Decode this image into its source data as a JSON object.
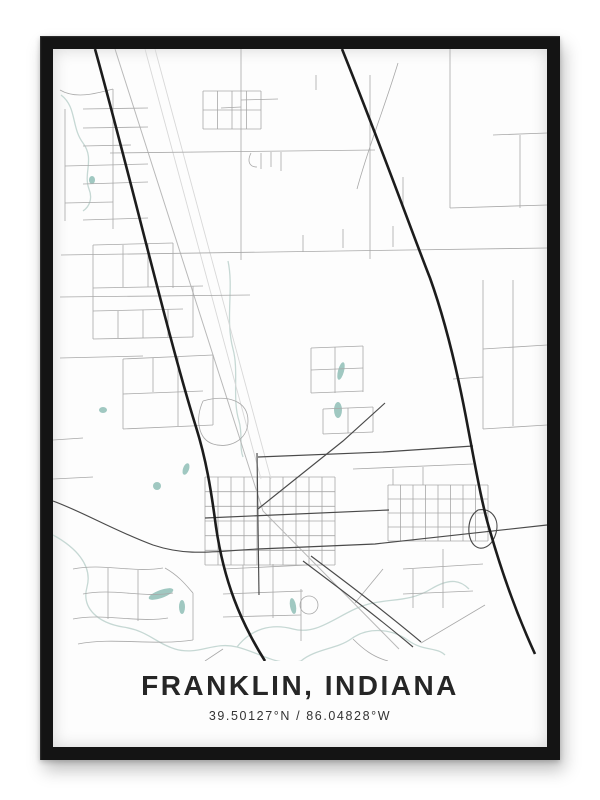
{
  "poster": {
    "title": "FRANKLIN, INDIANA",
    "coordinates": "39.50127°N / 86.04828°W"
  },
  "colors": {
    "frame": "#141414",
    "poster_bg": "#fdfdfd",
    "road_major": "#1c1c1c",
    "road_medium": "#4a4a4a",
    "road_minor": "#a8a8a8",
    "road_faint": "#d8d8d8",
    "rail": "#b9b9b9",
    "water": "#a0c8c1",
    "creek": "#c6d8d4",
    "title_text": "#262626",
    "coords_text": "#333333"
  },
  "map": {
    "viewbox": "0 0 494 612",
    "creeks": [
      "M0,486 C22,498 40,516 34,538 C28,560 46,574 70,578 C96,582 102,594 122,600 C146,607 160,592 184,598 C208,604 224,618 248,612",
      "M184,598 C198,580 218,574 240,580 C262,586 280,570 302,560 C330,547 352,556 378,540 C398,528 408,532 416,540",
      "M8,46 C24,58 18,78 30,94 C42,110 30,124 36,140 C40,150 36,158 30,162",
      "M248,612 C262,600 284,600 298,590 C316,577 340,580 356,592 C370,602 384,598 392,606",
      "M175,212 C181,240 172,270 180,300 C186,322 179,350 186,372 C190,386 186,398 190,408"
    ],
    "water_ellipses": [
      {
        "cx": 108,
        "cy": 545,
        "rx": 13,
        "ry": 4,
        "rot": -20
      },
      {
        "cx": 129,
        "cy": 558,
        "rx": 3,
        "ry": 7,
        "rot": 0
      },
      {
        "cx": 240,
        "cy": 557,
        "rx": 3,
        "ry": 8,
        "rot": -10
      },
      {
        "cx": 288,
        "cy": 322,
        "rx": 3,
        "ry": 9,
        "rot": 15
      },
      {
        "cx": 285,
        "cy": 361,
        "rx": 4,
        "ry": 8,
        "rot": 0
      },
      {
        "cx": 104,
        "cy": 437,
        "rx": 4,
        "ry": 4,
        "rot": 0
      },
      {
        "cx": 133,
        "cy": 420,
        "rx": 3,
        "ry": 6,
        "rot": 20
      },
      {
        "cx": 50,
        "cy": 361,
        "rx": 4,
        "ry": 3,
        "rot": 0
      },
      {
        "cx": 39,
        "cy": 131,
        "rx": 3,
        "ry": 4,
        "rot": 0
      }
    ],
    "layers": [
      {
        "cls": "faint",
        "paths": [
          "M102,0 L218,430",
          "M92,0 L208,430"
        ]
      },
      {
        "cls": "rail",
        "paths": [
          "M62,0 L210,462 L346,600"
        ]
      },
      {
        "cls": "road-min",
        "paths": [
          "M188,0 L188,211",
          "M188,51 L225,50",
          "M168,59 L188,58",
          "M263,26 L263,41",
          "M57,104 L322,101",
          "M208,104 L208,120",
          "M218,103 L218,118",
          "M228,103 L228,122",
          "M198,104 C194,112 196,118 204,118",
          "M8,206 L494,199",
          "M397,0 L397,159",
          "M317,26 L317,210",
          "M345,14 C331,60 316,96 304,140",
          "M440,86 L494,84",
          "M467,86 L467,159",
          "M397,159 L494,156",
          "M350,128 L350,159",
          "M290,199 L290,180",
          "M340,198 L340,177",
          "M250,203 L250,186",
          "M12,60 L12,172",
          "M60,40 L60,180",
          "M7,41 C22,50 42,45 60,40",
          "M30,60 L95,59",
          "M30,79 L95,78",
          "M30,97 L78,96",
          "M12,117 L95,115",
          "M30,135 L95,133",
          "M12,154 L60,153",
          "M30,171 L95,169",
          "M40,196 L40,290",
          "M40,196 L120,194",
          "M120,194 L120,239",
          "M40,239 L150,237",
          "M70,196 L70,238",
          "M95,195 L95,238",
          "M40,262 L130,260",
          "M40,290 L140,288",
          "M65,262 L65,289",
          "M90,261 L90,289",
          "M115,260 L115,288",
          "M140,237 L140,288",
          "M7,248 L197,246",
          "M7,309 L90,307",
          "M70,310 L160,306",
          "M70,310 L70,380",
          "M70,345 L150,342",
          "M70,380 L160,376",
          "M100,309 L100,343",
          "M125,308 L125,377",
          "M160,306 L160,376",
          "M150,352 C175,345 195,352 195,372 C195,392 175,400 160,395 C145,390 142,370 150,352",
          "M258,299 L310,297",
          "M258,299 L258,344",
          "M282,298 L282,344",
          "M310,297 L310,343",
          "M258,344 L310,342",
          "M258,321 L310,319",
          "M270,360 L320,358",
          "M270,385 L320,383",
          "M270,360 L270,385",
          "M295,359 L295,384",
          "M320,358 L320,383",
          "M430,231 L430,380",
          "M460,231 L460,377",
          "M430,300 L494,296",
          "M400,330 L430,328",
          "M430,380 L494,376",
          "M300,420 L420,415",
          "M340,420 L340,436",
          "M370,418 L370,436",
          "M0,430 L40,428",
          "M0,391 L30,389",
          "M20,520 C50,514 80,524 110,519",
          "M30,545 C60,539 90,549 120,544",
          "M20,570 C50,564 85,574 115,569",
          "M55,519 L55,570",
          "M85,521 L85,572",
          "M25,595 C60,588 100,597 140,591",
          "M140,544 L140,591",
          "M112,519 C128,528 136,540 140,544",
          "M170,520 L255,516",
          "M170,545 L250,542",
          "M190,516 L190,568",
          "M220,515 L220,569",
          "M170,568 L248,566",
          "M248,540 L248,592",
          "M247,556 a9,9 0 1 0 18,0 a9,9 0 1 0 -18,0",
          "M350,520 L430,515",
          "M390,500 L390,559",
          "M350,545 L420,542",
          "M360,520 L360,559",
          "M330,520 L302,554",
          "M368,594 L432,556",
          "M170,600 L152,612",
          "M300,590 C310,600 320,608 335,612"
        ]
      },
      {
        "cls": "road-med",
        "paths": [
          "M0,452 C28,462 62,482 100,496 C136,508 162,502 205,500 L322,495 C372,489 432,483 494,476",
          "M152,469 L336,461",
          "M204,404 L206,546",
          "M205,460 L290,392 L332,354",
          "M205,408 L330,403 L420,397",
          "M425,461 C438,458 447,470 443,484 C439,498 428,503 421,496 C414,489 413,469 425,461",
          "M250,512 C282,536 322,566 360,598",
          "M258,507 C290,531 330,561 368,593"
        ]
      },
      {
        "cls": "road-major",
        "paths": [
          "M42,0 C76,122 116,292 143,378 C153,410 158,440 163,478 C171,532 187,572 212,612",
          "M289,0 C330,102 360,186 377,229 C396,282 408,341 415,379 C423,421 429,456 437,482 C449,524 465,568 482,605"
        ]
      }
    ],
    "grids": [
      {
        "cls": "road-min",
        "x0": 152,
        "y0": 428,
        "w": 130,
        "h": 88,
        "nx": 10,
        "ny": 6
      },
      {
        "cls": "road-min",
        "x0": 335,
        "y0": 436,
        "w": 100,
        "h": 56,
        "nx": 8,
        "ny": 4
      },
      {
        "cls": "road-min",
        "x0": 150,
        "y0": 42,
        "w": 58,
        "h": 38,
        "nx": 4,
        "ny": 2
      }
    ]
  }
}
